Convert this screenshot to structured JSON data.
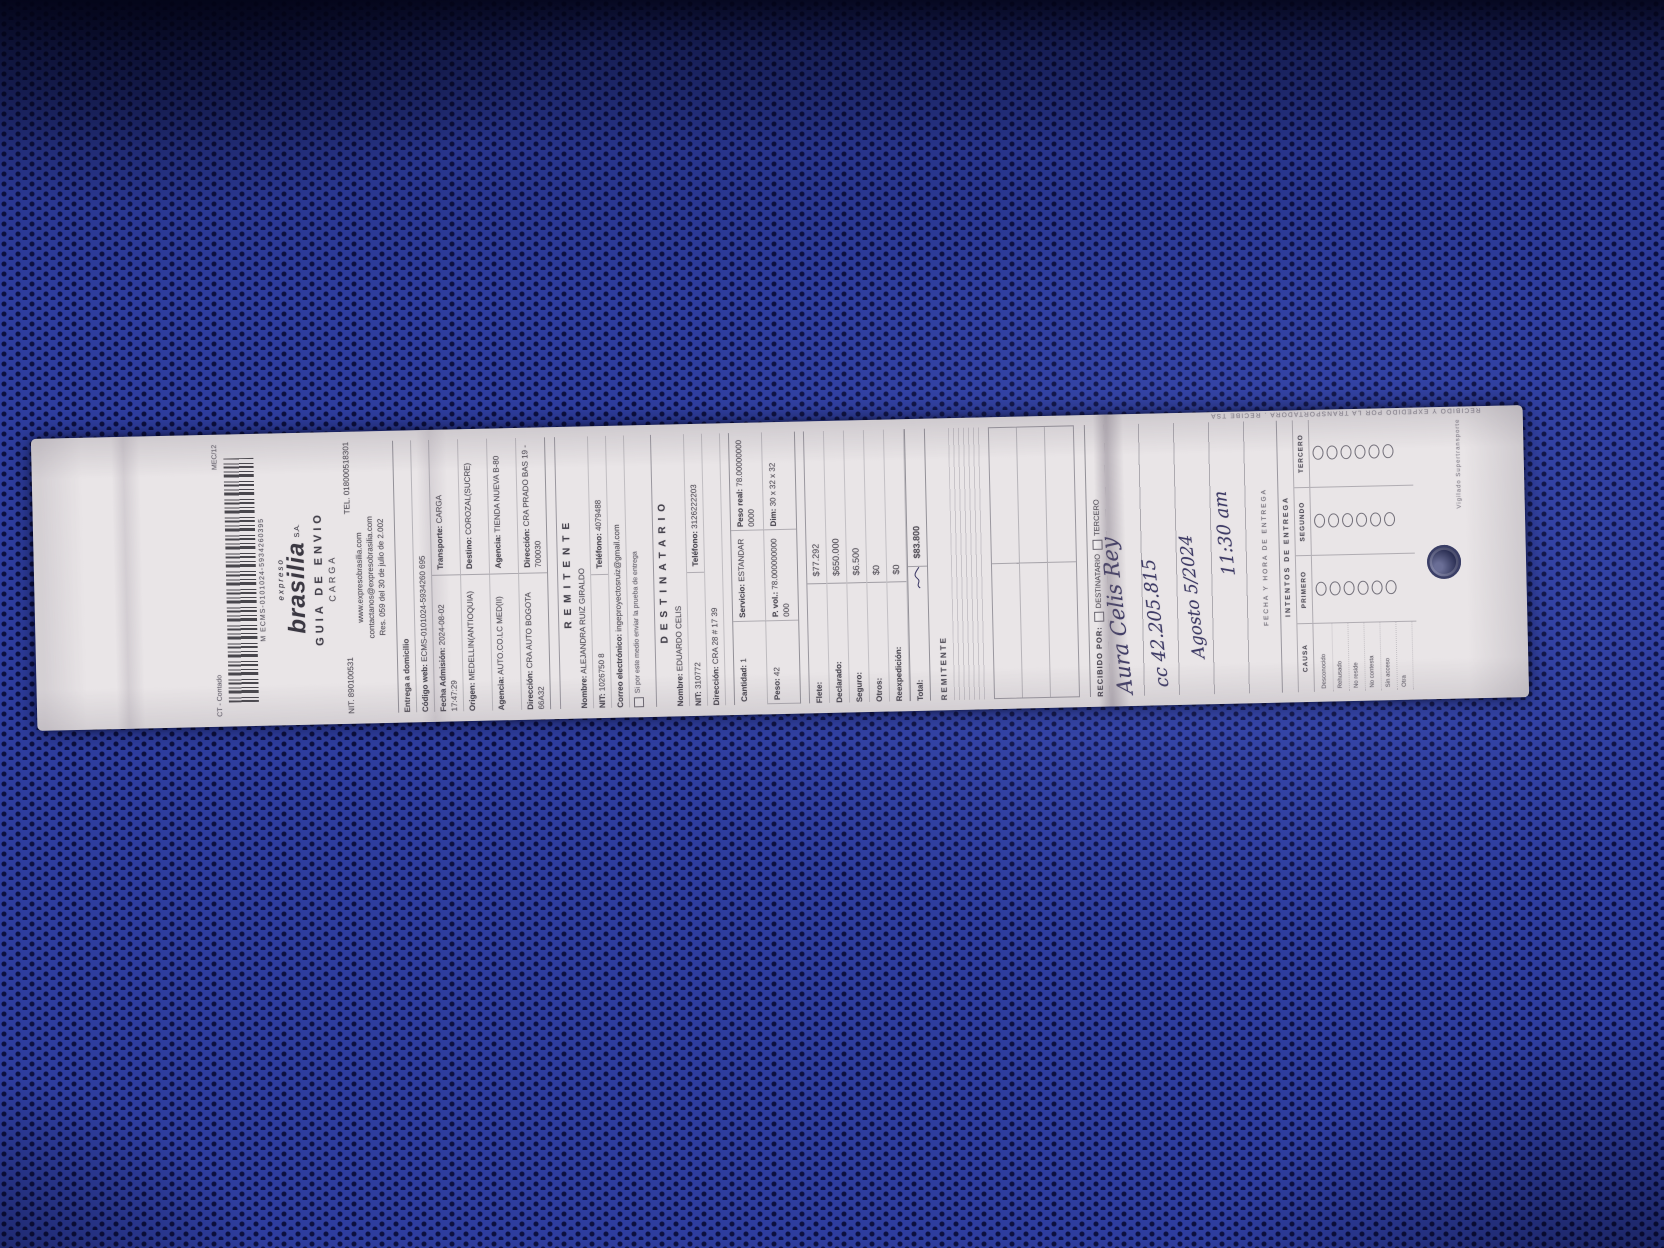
{
  "scene": {
    "background_base_color": "#2e3d9e",
    "background_dot_color": "#0c1040",
    "shadow_color": "#030416",
    "paper_color": "#e9e5e7",
    "print_ink_color": "#56525a",
    "handwriting_ink_color": "#3d3a66",
    "description": "white shipping waybill lying rotated on blue perforated fabric"
  },
  "receipt": {
    "corner_left": "CT - Contado",
    "corner_right": "MEC/12",
    "barcode_number": "M  ECMS-0101024-5934260395",
    "brand_pre": "expreso",
    "brand_name": "brasilia",
    "brand_suffix": "S.A.",
    "doc_title": "GUIA  DE  ENVIO",
    "doc_subtitle": "CARGA",
    "nit": "NIT. 890100531",
    "tel": "TEL. 018000518301",
    "website": "www.expresobrasilia.com",
    "email": "contactanos@expresobrasilia.com",
    "resolution": "Res. 059 del 30 de julio de 2.002",
    "admission": {
      "delivery_mode": "Entrega a domicilio",
      "web_code_label": "Código web:",
      "web_code": "ECMS-0101024-5934260 695",
      "rows": [
        {
          "label": "Fecha Admisión:",
          "value": "2024-08-02 17:47:29"
        },
        {
          "label": "Transporte:",
          "value": "CARGA"
        },
        {
          "label": "Origen:",
          "value": "MEDELLIN(ANTIOQUIA)"
        },
        {
          "label": "Destino:",
          "value": "COROZAL(SUCRE)"
        },
        {
          "label": "Agencia:",
          "value": "AUTO.CO.LC MED(II)"
        },
        {
          "label": "Agencia:",
          "value": "TIENDA NUEVA B-80"
        },
        {
          "label": "Dirección:",
          "value": "CRA AUTO BOGOTA 66A32"
        },
        {
          "label": "Dirección:",
          "value": "CRA PRADO BAS 19 - 700030"
        }
      ]
    },
    "sender": {
      "section_title": "REMITENTE",
      "name_label": "Nombre:",
      "name": "ALEJANDRA RUIZ GIRALDO",
      "id_label": "NIT:",
      "id": "1026750 8",
      "phone_label": "Teléfono:",
      "phone": "4079488",
      "email_label": "Correo electrónico:",
      "email": "ingeproyectosruiz@gmail.com",
      "note": "Si por este medio enviar la prueba de entrega"
    },
    "recipient": {
      "section_title": "DESTINATARIO",
      "name_label": "Nombre:",
      "name": "EDUARDO CELIS",
      "id_label": "NIT:",
      "id": "310772",
      "phone_label": "Teléfono:",
      "phone": "3126222203",
      "address_label": "Dirección:",
      "address": "CRA 28 # 17 39"
    },
    "package": {
      "cells": [
        {
          "label": "Cantidad:",
          "value": "1"
        },
        {
          "label": "Servicio:",
          "value": "ESTANDAR"
        },
        {
          "label": "Peso real:",
          "value": "78.000000000000"
        },
        {
          "label": "Peso:",
          "value": "42"
        },
        {
          "label": "P. vol.:",
          "value": "78.000000000000"
        },
        {
          "label": "Dim:",
          "value": "30 x 32 x 32"
        }
      ]
    },
    "charges": {
      "rows": [
        {
          "label": "Flete:",
          "value": "$77.292"
        },
        {
          "label": "Declarado:",
          "value": "$650.000"
        },
        {
          "label": "Seguro:",
          "value": "$6.500"
        },
        {
          "label": "Otros:",
          "value": "$0"
        },
        {
          "label": "Reexpedición:",
          "value": "$0"
        }
      ],
      "total_label": "Total:",
      "total_value": "$83.800"
    },
    "sender_signature_label": "REMITENTE",
    "received": {
      "title": "RECIBIDO POR:",
      "option_1": "DESTINATARIO",
      "option_2": "TERCERO",
      "handwriting_name": "Aura Celis Rey",
      "handwriting_id": "cc 42.205.815",
      "handwriting_date": "Agosto 5/2024",
      "handwriting_time": "11:30 am",
      "caption": "FECHA Y HORA DE ENTREGA"
    },
    "attempts": {
      "title": "INTENTOS DE ENTREGA",
      "columns": [
        "PRIMERO",
        "SEGUNDO",
        "TERCERO"
      ],
      "circles_per_column": 6
    },
    "cause": {
      "title": "CAUSA",
      "items": [
        "Desconocido",
        "Rehusado",
        "No reside",
        "No contesta",
        "Sin acceso",
        "Otra"
      ]
    },
    "footer": {
      "edge_note": "RECIBIDO Y EXPEDIDO POR LA TRANSPORTADORA . RECIBE TSA",
      "vigilado": "Vigilado Supertransporte"
    }
  }
}
